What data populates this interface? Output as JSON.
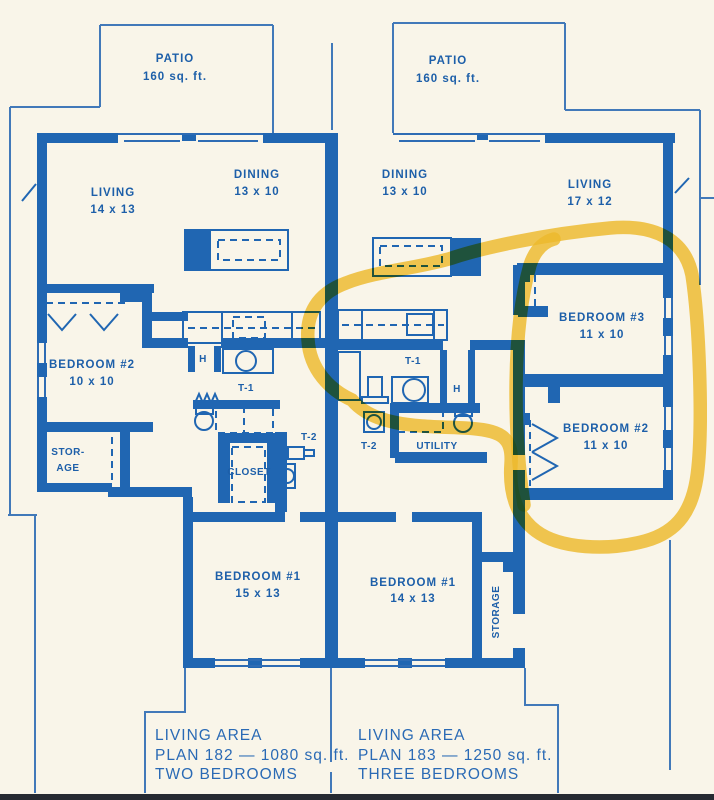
{
  "colors": {
    "ink": "#2066b2",
    "paper": "#f9f5e9",
    "highlight": "#f3c12f"
  },
  "left_unit": {
    "patio": {
      "name": "PATIO",
      "area": "160 sq. ft."
    },
    "living": {
      "name": "LIVING",
      "dims": "14 x 13"
    },
    "dining": {
      "name": "DINING",
      "dims": "13 x 10"
    },
    "bedroom2": {
      "name": "BEDROOM #2",
      "dims": "10 x 10"
    },
    "bedroom1": {
      "name": "BEDROOM #1",
      "dims": "15 x 13"
    },
    "storage": {
      "line1": "STOR-",
      "line2": "AGE"
    },
    "heater": "H",
    "bath1": "T-1",
    "bath2": "T-2",
    "closet": "CLOSET",
    "summary": {
      "line1": "LIVING AREA",
      "line2": "PLAN 182 — 1080 sq. ft.",
      "line3": "TWO BEDROOMS"
    }
  },
  "right_unit": {
    "patio": {
      "name": "PATIO",
      "area": "160 sq. ft."
    },
    "dining": {
      "name": "DINING",
      "dims": "13 x 10"
    },
    "living": {
      "name": "LIVING",
      "dims": "17 x 12"
    },
    "bedroom3": {
      "name": "BEDROOM #3",
      "dims": "11 x 10"
    },
    "bedroom2": {
      "name": "BEDROOM #2",
      "dims": "11 x 10"
    },
    "bedroom1": {
      "name": "BEDROOM #1",
      "dims": "14 x 13"
    },
    "storage": "STORAGE",
    "utility": "UTILITY",
    "heater": "H",
    "bath1": "T-1",
    "bath2": "T-2",
    "summary": {
      "line1": "LIVING AREA",
      "line2": "PLAN 183 — 1250 sq. ft.",
      "line3": "THREE BEDROOMS"
    }
  }
}
